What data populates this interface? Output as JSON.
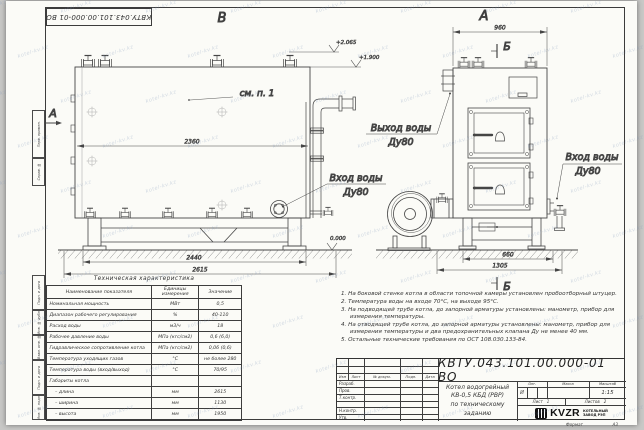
{
  "watermark": "kotel-kv.kz",
  "sheet": {
    "stamp_top": "КВТУ.043.101.00.000-01  ВО",
    "format_label": "Формат",
    "format_value": "А3",
    "margin_labels": [
      "Перв. примен.",
      "Справ. №",
      "Подп. и дата",
      "Инв. № дубл.",
      "Взам. инв. №",
      "Подп. и дата",
      "Инв. № подл."
    ]
  },
  "views": {
    "side": {
      "label": "В",
      "section_label": "А",
      "see_note": "см. п. 1",
      "dims": {
        "body": "2360",
        "frame": "2440",
        "total": "2615"
      },
      "elev_top": "+2.065",
      "elev_mid": "+1.900",
      "elev_zero": "0.000",
      "inlet1": "Вход воды",
      "inlet2": "Ду80"
    },
    "front": {
      "label": "А",
      "section_label": "Б",
      "dims": {
        "top": "960",
        "base": "660",
        "total": "1305"
      },
      "outlet1": "Выход воды",
      "outlet2": "Ду80",
      "inlet1": "Вход воды",
      "inlet2": "Ду80"
    }
  },
  "spec_table": {
    "title": "Техническая характеристика",
    "headers": [
      "Наименование показателя",
      "Единицы измерения",
      "Значение"
    ],
    "rows": [
      [
        "Номинальная мощность",
        "МВт",
        "0,5"
      ],
      [
        "Диапазон рабочего регулирования",
        "%",
        "40-110"
      ],
      [
        "Расход воды",
        "м3/ч",
        "18"
      ],
      [
        "Рабочее давление воды",
        "МПа (кгс/см2)",
        "0,6 (6,0)"
      ],
      [
        "Гидравлическое сопротивление котла",
        "МПа (кгс/см2)",
        "0,06 (0,6)"
      ],
      [
        "Температура уходящих газов",
        "°С",
        "не более 280"
      ],
      [
        "Температура воды (вход/выход)",
        "°С",
        "70/95"
      ],
      [
        "Габариты котла",
        "",
        ""
      ],
      [
        "– длина",
        "мм",
        "2615"
      ],
      [
        "– ширина",
        "мм",
        "1130"
      ],
      [
        "– высота",
        "мм",
        "1950"
      ]
    ]
  },
  "notes": [
    "1.  На боковой стенке котла в области топочной камеры установлен пробоотборный штуцер.",
    "2.  Температура воды на входе 70°С, на выходе 95°С.",
    "3.  На подводящей трубе котла, до запорной арматуры установлены: манометр, прибор для измерения температуры.",
    "4.  На отводящей трубе котла, до запорной арматуры установлены: манометр, прибор для измерения температуры и два предохранительных клапана Ду не менее 40 мм.",
    "5.  Остальные технические требования по ОСТ 108.030.133-84."
  ],
  "title_block": {
    "doc_number": "КВТУ.043.101.00.000-01  ВО",
    "title_line1": "Котел водогрейный",
    "title_line2": "КВ-0,5  КБД  (РВР)",
    "title_line3": "по техническому заданию",
    "header_cols": [
      "Изм",
      "Лист",
      "№ докум.",
      "Подп.",
      "Дата"
    ],
    "sig_rows": [
      "Разраб.",
      "Пров.",
      "Т.контр.",
      "Н.контр.",
      "Утв."
    ],
    "lit_label": "Лит.",
    "mass_label": "Масса",
    "scale_label": "Масштаб",
    "lit_value": "И",
    "scale_value": "1:15",
    "sheet_label": "Лист",
    "sheet_value": "1",
    "sheets_label": "Листов",
    "sheets_value": "2",
    "company_logo": "KVZR",
    "company_line1": "КОТЕЛЬНЫЙ",
    "company_line2": "ЗАВОД РЭП"
  }
}
